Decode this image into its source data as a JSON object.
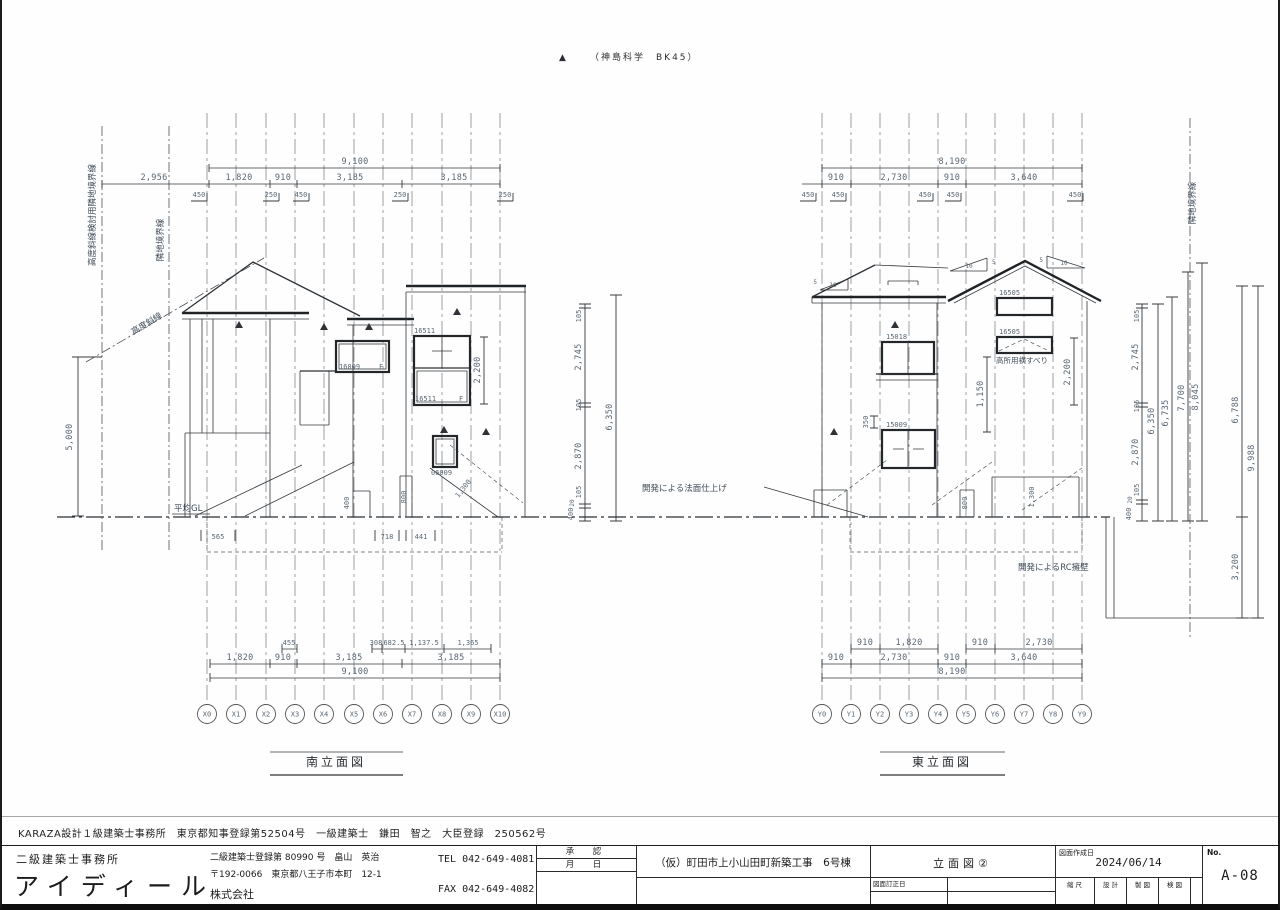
{
  "header": {
    "marker": "▲",
    "note": "（神島科学　BK45）"
  },
  "south": {
    "title": "南立面図",
    "grid": [
      "X0",
      "X1",
      "X2",
      "X3",
      "X4",
      "X5",
      "X6",
      "X7",
      "X8",
      "X9",
      "X10"
    ],
    "top_dims": {
      "d2956": "2,956",
      "total": "9,100",
      "segs": [
        "1,820",
        "910",
        "3,185",
        "3,185"
      ],
      "offsets": [
        "450",
        "250",
        "450",
        "250",
        "250"
      ]
    },
    "bottom_dims": {
      "subs": [
        "455",
        "308",
        "682.5",
        "1,137.5",
        "1,365"
      ],
      "segs": [
        "1,820",
        "910",
        "3,185",
        "3,185"
      ],
      "total": "9,100"
    },
    "height_left": "5,000",
    "vchain": [
      "105",
      "2,745",
      "105",
      "2,870",
      "105",
      "20",
      "400"
    ],
    "vtotal": "6,350",
    "labels": {
      "boundary_long": "高度斜線検討用隣地境界線",
      "boundary": "隣地境界線",
      "slant": "高度斜線",
      "gl": "平均GL"
    },
    "windows": {
      "w1t": "16511",
      "w1b": "16511",
      "w1f": "F",
      "w2": "16009",
      "w2f": "F",
      "w3": "06009"
    },
    "dims": {
      "h2200": "2,200",
      "d400": "400",
      "d800": "800",
      "d1300": "1,300",
      "d565": "565",
      "d718": "718",
      "d441": "441"
    }
  },
  "east": {
    "title": "東立面図",
    "grid": [
      "Y0",
      "Y1",
      "Y2",
      "Y3",
      "Y4",
      "Y5",
      "Y6",
      "Y7",
      "Y8",
      "Y9"
    ],
    "top_dims": {
      "total": "8,190",
      "segs": [
        "910",
        "2,730",
        "910",
        "3,640"
      ],
      "offsets": [
        "450",
        "450",
        "450",
        "450",
        "450"
      ]
    },
    "bottom_dims": {
      "subs": [
        "910",
        "1,820",
        "910",
        "2,730"
      ],
      "segs": [
        "910",
        "2,730",
        "910",
        "3,640"
      ],
      "total": "8,190"
    },
    "vchain": [
      "105",
      "2,745",
      "105",
      "2,870",
      "105",
      "20",
      "400"
    ],
    "vtotals": [
      "6,350",
      "6,735",
      "7,700",
      "8,045"
    ],
    "right_dims": {
      "d6788": "6,788",
      "d9988": "9,988",
      "d3200": "3,200"
    },
    "labels": {
      "boundary": "隣地境界線",
      "slope_note": "開発による法面仕上げ",
      "rc_note": "開発によるRC擁壁",
      "high_window": "高所用横すべり"
    },
    "windows": {
      "w1": "15018",
      "w2": "15009",
      "w3t": "16505",
      "w3b": "16505"
    },
    "dims": {
      "h2200": "2,200",
      "d1150": "1,150",
      "d350": "350",
      "d800": "800",
      "d1300": "1,300",
      "slope10": "10",
      "slope5": "5"
    }
  },
  "footer": {
    "license": "KARAZA設計１級建築士事務所　東京都知事登録第52504号　一級建築士　鎌田　智之　大臣登録　250562号",
    "office_type": "二級建築士事務所",
    "office_name": "アイディール",
    "reg": "二級建築士登録第 80990 号　畠山　英治",
    "addr": "〒192-0066　東京都八王子市本町　12-1",
    "corp": "株式会社",
    "tel": "TEL 042-649-4081",
    "fax": "FAX 042-649-4082",
    "approval": "承　認",
    "month_day": "月　日",
    "project": "（仮）町田市上小山田町新築工事　6号棟",
    "sheet_title": "立面図②",
    "revision": "図面訂正日",
    "created_label": "図面作成日",
    "created": "2024/06/14",
    "scale": "縮 尺",
    "design": "設 計",
    "draft": "製 図",
    "check": "検 図",
    "no_label": "No.",
    "sheet_no": "A-08"
  }
}
